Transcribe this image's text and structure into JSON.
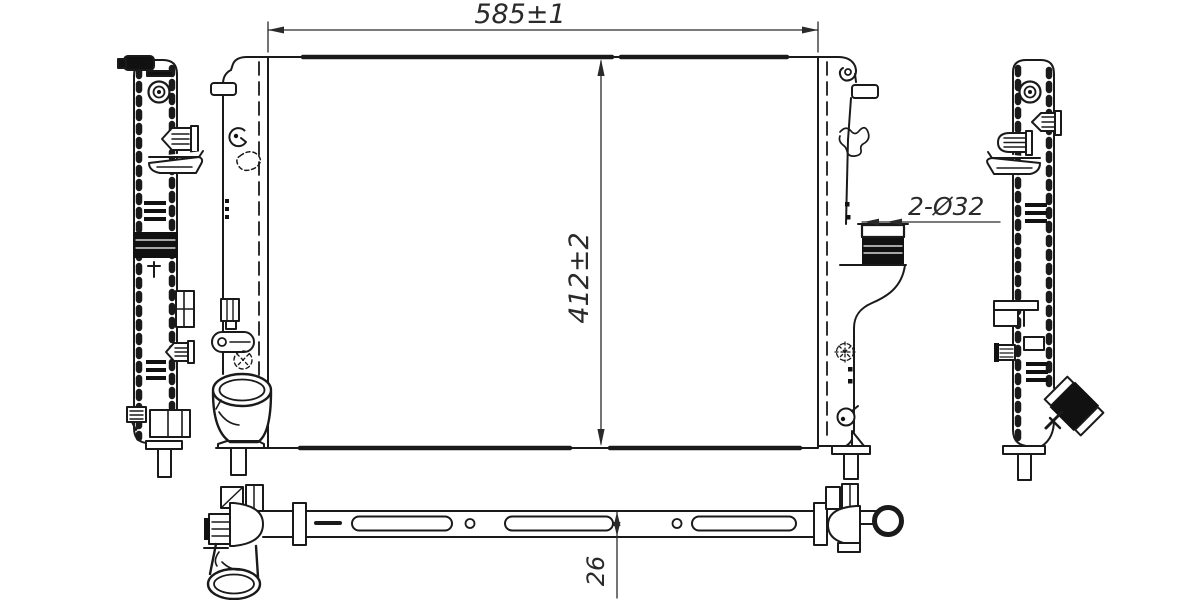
{
  "drawing": {
    "type": "engineering-drawing",
    "subject": "automotive radiator, four orthographic views",
    "ink_color": "#1a1a1a",
    "background": "#ffffff",
    "annotations": {
      "overall_width": "585±1",
      "overall_height": "412±2",
      "core_thickness": "26",
      "ports": "2-Ø32"
    },
    "views": {
      "front": "front view with core and side tanks",
      "left": "left side profile view",
      "right": "right side profile view",
      "bottom": "bottom view of core band with slots"
    }
  }
}
